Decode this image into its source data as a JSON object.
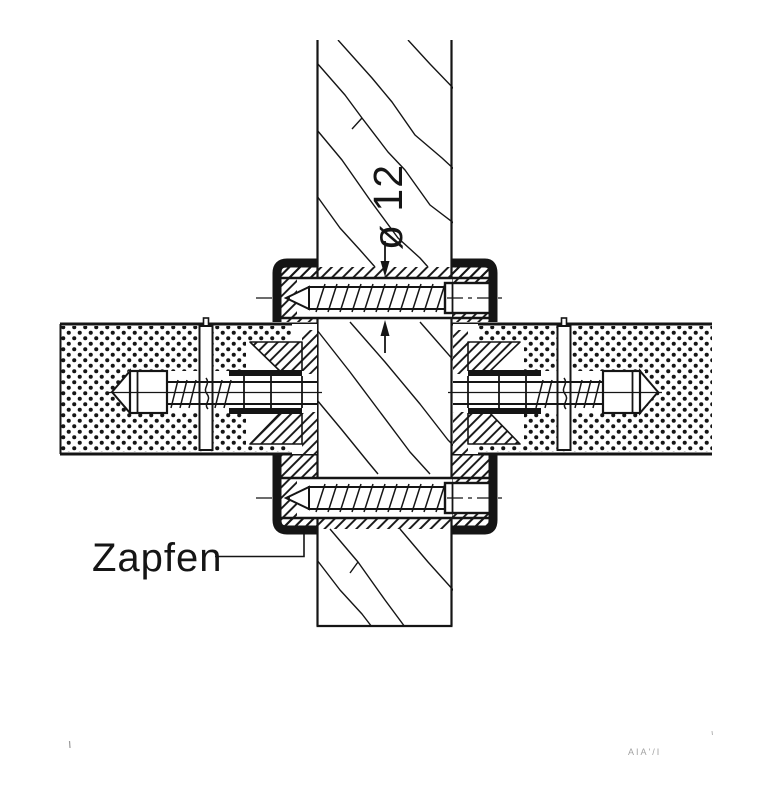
{
  "drawing": {
    "labels": {
      "tenon": "Zapfen",
      "diameter": "ø 12",
      "artifact_text": "AIA'/I"
    },
    "colors": {
      "ink": "#151515",
      "paper": "#ffffff",
      "faint": "#8a8a8a"
    }
  }
}
